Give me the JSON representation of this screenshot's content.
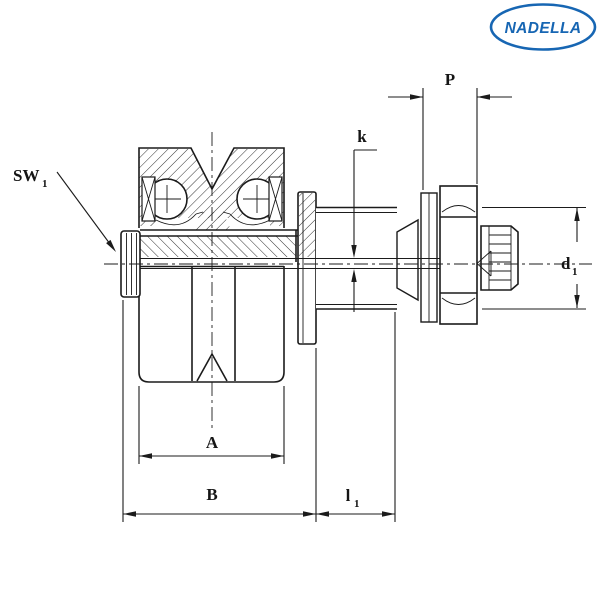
{
  "logo": {
    "text": "NADELLA",
    "color": "#1766b3"
  },
  "drawing": {
    "ink_color": "#1b1b1b",
    "background_color": "#ffffff",
    "labels": {
      "p": "P",
      "k": "k",
      "a": "A",
      "b": "B",
      "sw1": {
        "main": "SW",
        "sub": "1"
      },
      "l1": {
        "main": "l",
        "sub": "1"
      },
      "d1": {
        "main": "d",
        "sub": "1"
      }
    }
  }
}
